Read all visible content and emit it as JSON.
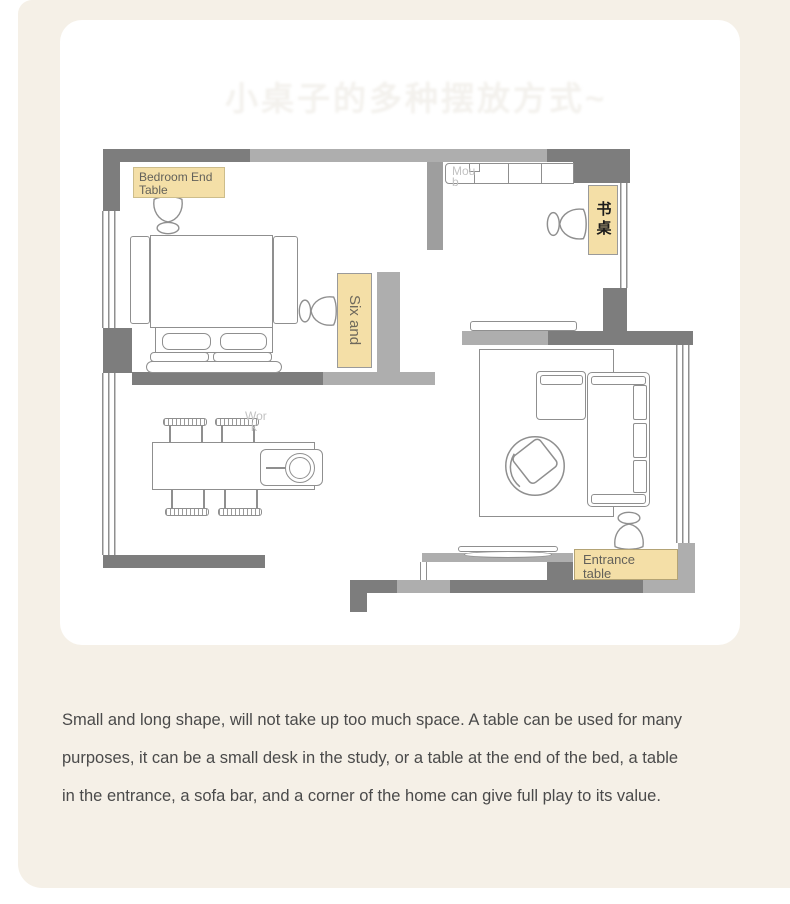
{
  "colors": {
    "panel_bg": "#f5f0e7",
    "card_bg": "#ffffff",
    "label_bg": "#f4dfa7",
    "wall_dark": "#7d7d7d",
    "wall_light": "#aeaeae",
    "body_text": "#4a4a4a"
  },
  "watermark": {
    "title": "小桌子的多种摆放方式~"
  },
  "plan": {
    "labels": {
      "bedroom_end_table": {
        "lines": [
          "Bedroom End",
          "Table"
        ]
      },
      "six_and": {
        "text": "Six and"
      },
      "desk_cn": {
        "text": "书桌"
      },
      "entrance_table": {
        "lines": [
          "Entrance",
          "table"
        ]
      },
      "wardrobe_ghost": {
        "lines": [
          "Mou",
          "b"
        ]
      },
      "work_ghost": {
        "lines": [
          "Wor",
          "k"
        ]
      }
    }
  },
  "description": {
    "lines": [
      "Small and long shape, will not take up too much space. A table can be used for many",
      "purposes, it can be a small desk in the study, or a table at the end of the bed, a table",
      "in the entrance, a sofa bar, and a corner of the home can give full play to its value."
    ]
  }
}
